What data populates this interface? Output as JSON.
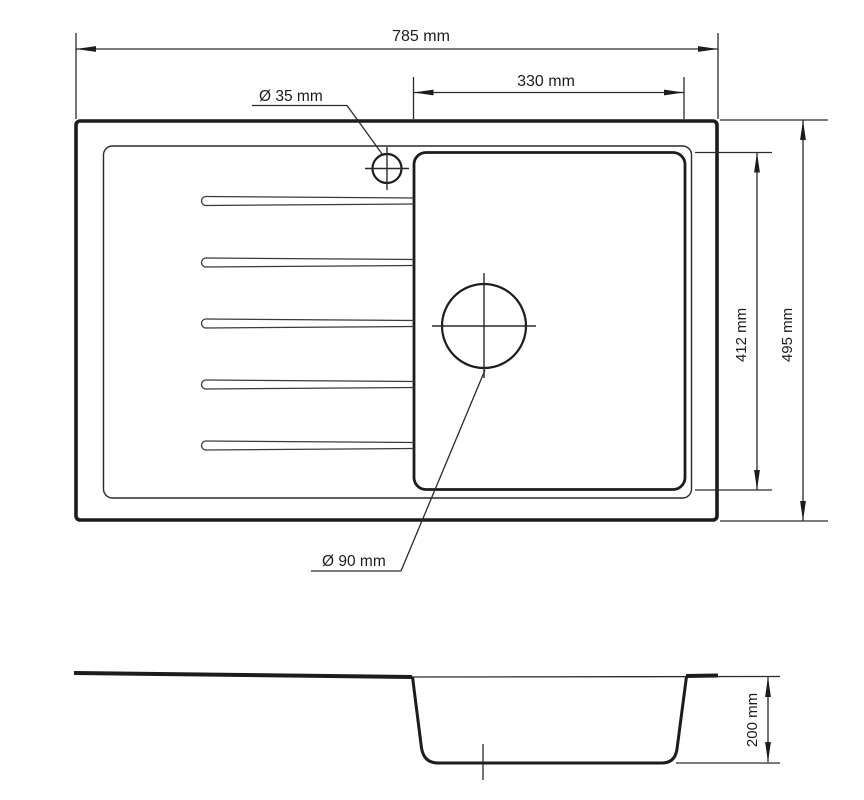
{
  "labels": {
    "overall_width": "785 mm",
    "bowl_width": "330 mm",
    "tap_hole_diameter": "Ø 35 mm",
    "drain_diameter": "Ø 90 mm",
    "bowl_length": "412 mm",
    "overall_length": "495 mm",
    "bowl_depth": "200 mm"
  }
}
